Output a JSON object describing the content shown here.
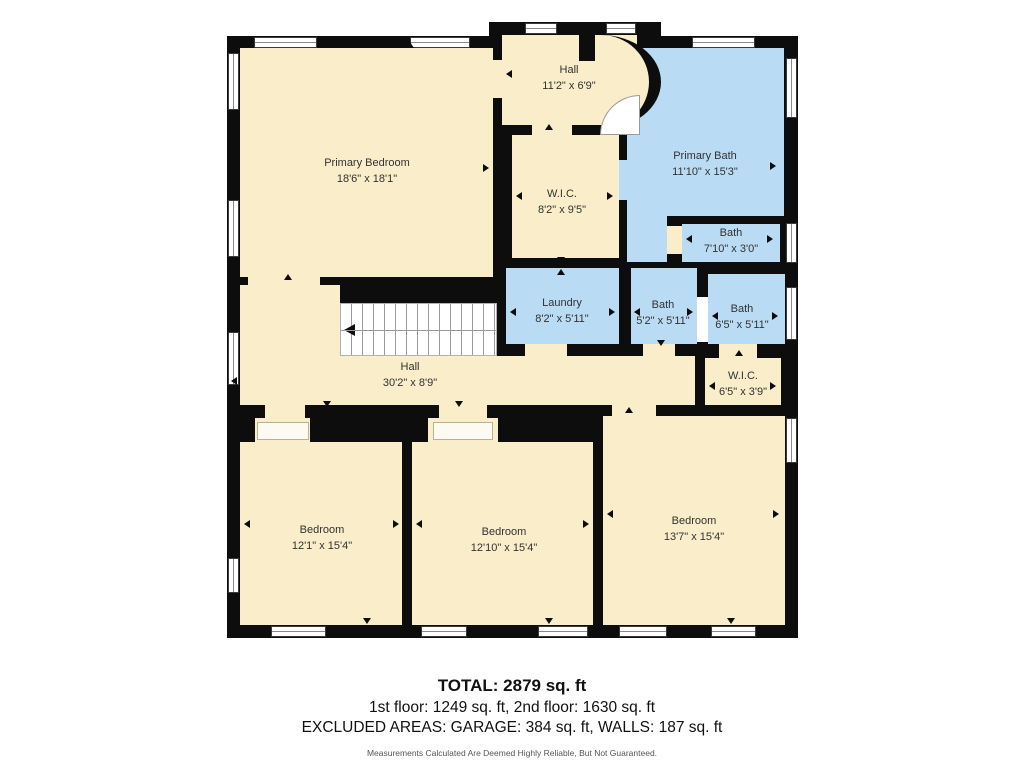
{
  "plan": {
    "rooms": [
      {
        "id": "primary-bedroom",
        "name": "Primary Bedroom",
        "dims": "18'6\" x 18'1\""
      },
      {
        "id": "hall-upper",
        "name": "Hall",
        "dims": "11'2\" x 6'9\""
      },
      {
        "id": "wic-upper",
        "name": "W.I.C.",
        "dims": "8'2\" x 9'5\""
      },
      {
        "id": "primary-bath",
        "name": "Primary Bath",
        "dims": "11'10\" x 15'3\""
      },
      {
        "id": "bath-small",
        "name": "Bath",
        "dims": "7'10\" x 3'0\""
      },
      {
        "id": "laundry",
        "name": "Laundry",
        "dims": "8'2\" x 5'11\""
      },
      {
        "id": "bath-center",
        "name": "Bath",
        "dims": "5'2\" x 5'11\""
      },
      {
        "id": "bath-right",
        "name": "Bath",
        "dims": "6'5\" x 5'11\""
      },
      {
        "id": "hall-main",
        "name": "Hall",
        "dims": "30'2\" x 8'9\""
      },
      {
        "id": "wic-lower",
        "name": "W.I.C.",
        "dims": "6'5\" x 3'9\""
      },
      {
        "id": "bedroom-left",
        "name": "Bedroom",
        "dims": "12'1\" x 15'4\""
      },
      {
        "id": "bedroom-center",
        "name": "Bedroom",
        "dims": "12'10\" x 15'4\""
      },
      {
        "id": "bedroom-right",
        "name": "Bedroom",
        "dims": "13'7\" x 15'4\""
      }
    ],
    "colors": {
      "room_fill": "#f9edca",
      "wet_fill": "#badbf4",
      "wall": "#0d0d0d",
      "background": "#ffffff"
    }
  },
  "footer": {
    "total": "TOTAL: 2879 sq. ft",
    "floors": "1st floor: 1249 sq. ft, 2nd floor: 1630 sq. ft",
    "excluded": "EXCLUDED AREAS: GARAGE: 384 sq. ft, WALLS: 187 sq. ft",
    "disclaimer": "Measurements Calculated Are Deemed Highly Reliable, But Not Guaranteed."
  }
}
